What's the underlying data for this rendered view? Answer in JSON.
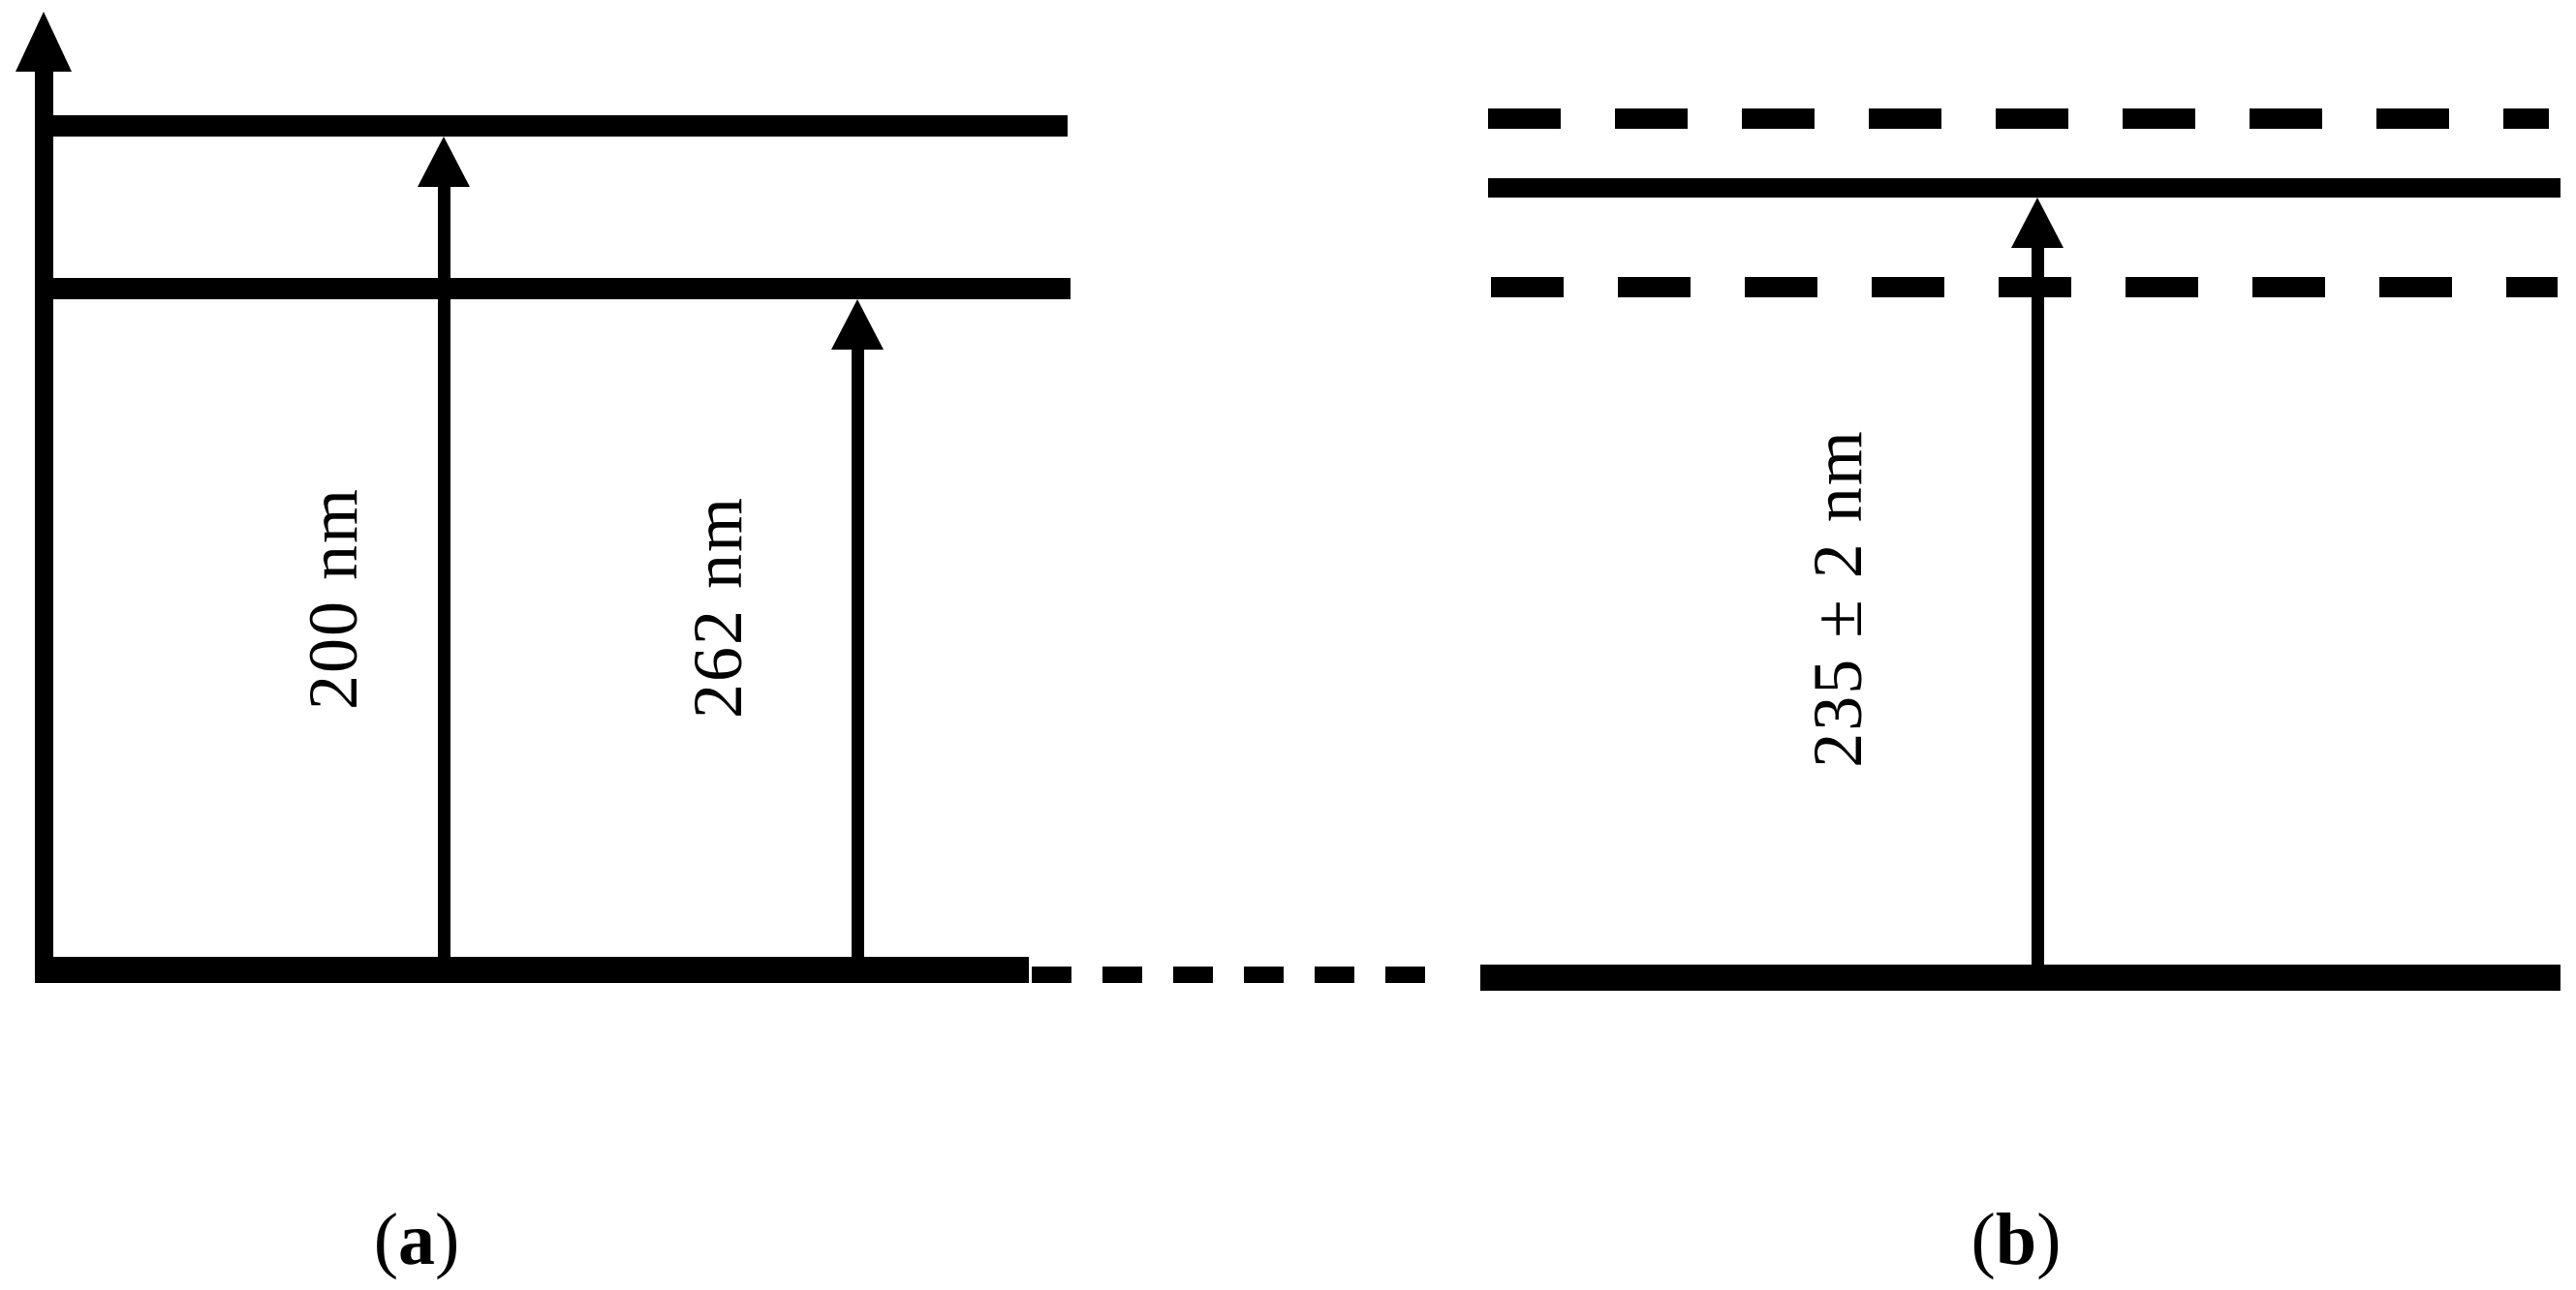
{
  "colors": {
    "ink": "#000000",
    "background": "#ffffff"
  },
  "panel_a": {
    "caption": {
      "open": "(",
      "letter": "a",
      "close": ")"
    },
    "axis": {
      "name": "energy-axis",
      "direction": "up"
    },
    "levels": [
      {
        "name": "excited-level-upper",
        "style": "solid"
      },
      {
        "name": "excited-level-lower",
        "style": "solid"
      },
      {
        "name": "ground-level",
        "style": "solid"
      }
    ],
    "transitions": [
      {
        "label": "200 nm",
        "from": "ground-level",
        "to": "excited-level-upper"
      },
      {
        "label": "262 nm",
        "from": "ground-level",
        "to": "excited-level-lower"
      }
    ]
  },
  "panel_b": {
    "caption": {
      "open": "(",
      "letter": "b",
      "close": ")"
    },
    "levels": [
      {
        "name": "band-upper-edge",
        "style": "dashed"
      },
      {
        "name": "resonance-level",
        "style": "solid"
      },
      {
        "name": "band-lower-edge",
        "style": "dashed"
      },
      {
        "name": "ground-level",
        "style": "solid"
      }
    ],
    "transitions": [
      {
        "label": "235 ± 2 nm",
        "from": "ground-level",
        "to": "resonance-level"
      }
    ]
  },
  "connector": {
    "name": "ground-level-connector",
    "style": "dashed"
  }
}
